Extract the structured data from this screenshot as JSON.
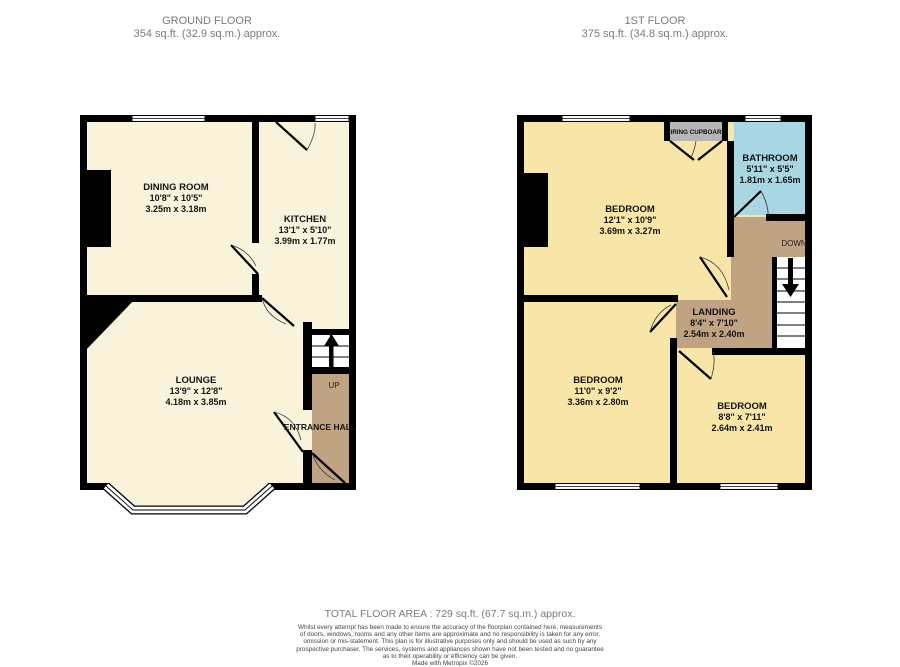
{
  "ground_floor": {
    "title": "GROUND FLOOR",
    "area": "354 sq.ft. (32.9 sq.m.) approx.",
    "rooms": {
      "dining": {
        "name": "DINING ROOM",
        "imperial": "10'8\" x 10'5\"",
        "metric": "3.25m x 3.18m"
      },
      "kitchen": {
        "name": "KITCHEN",
        "imperial": "13'1\" x 5'10\"",
        "metric": "3.99m x 1.77m"
      },
      "lounge": {
        "name": "LOUNGE",
        "imperial": "13'9\" x 12'8\"",
        "metric": "4.18m x 3.85m"
      },
      "entrance_hall": {
        "name": "ENTRANCE HALL"
      }
    },
    "stairs_label": "UP"
  },
  "first_floor": {
    "title": "1ST FLOOR",
    "area": "375 sq.ft. (34.8 sq.m.) approx.",
    "rooms": {
      "bedroom1": {
        "name": "BEDROOM",
        "imperial": "12'1\" x 10'9\"",
        "metric": "3.69m x 3.27m"
      },
      "bathroom": {
        "name": "BATHROOM",
        "imperial": "5'11\" x 5'5\"",
        "metric": "1.81m x 1.65m"
      },
      "landing": {
        "name": "LANDING",
        "imperial": "8'4\" x 7'10\"",
        "metric": "2.54m x 2.40m"
      },
      "bedroom2": {
        "name": "BEDROOM",
        "imperial": "11'0\" x 9'2\"",
        "metric": "3.36m x 2.80m"
      },
      "bedroom3": {
        "name": "BEDROOM",
        "imperial": "8'8\" x 7'11\"",
        "metric": "2.64m x 2.41m"
      },
      "airing_cupboard": {
        "name": "AIRING CUPBOARD"
      }
    },
    "stairs_label": "DOWN"
  },
  "footer": {
    "total_area": "TOTAL FLOOR AREA : 729 sq.ft. (67.7 sq.m.) approx.",
    "disclaimer_lines": [
      "Whilst every attempt has been made to ensure the accuracy of the floorplan contained here, measurements",
      "of doors, windows, rooms and any other items are approximate and no responsibility is taken for any error,",
      "omission or mis-statement. This plan is for illustrative purposes only and should be used as such by any",
      "prospective purchaser. The services, systems and appliances shown have not been tested and no guarantee",
      "as to their operability or efficiency can be given."
    ],
    "credit": "Made with Metropix ©2026"
  },
  "colors": {
    "wall": "#000000",
    "ground_room": "#faf3dc",
    "first_room": "#f8e5a8",
    "bathroom": "#a9d6e3",
    "hall_landing": "#bfa383",
    "cupboard": "#b5b5b5",
    "title_text": "#7b7b7b"
  }
}
